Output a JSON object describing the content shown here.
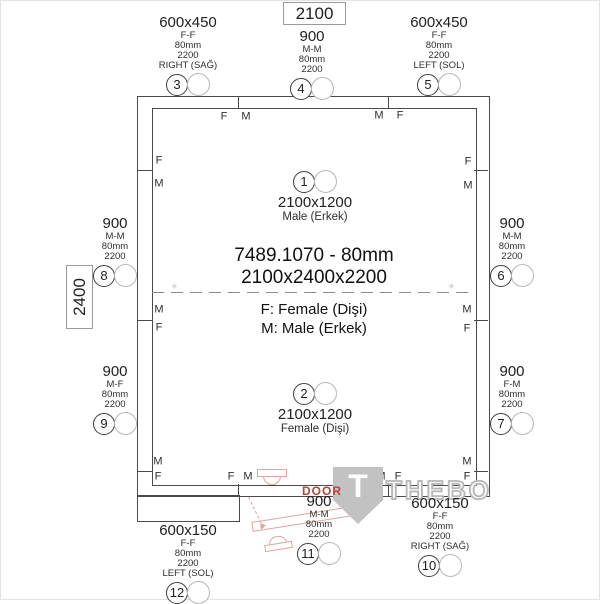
{
  "header": {
    "title": "7489.1070 - 80mm",
    "dims": "2100x2400x2200",
    "legend_f": "F: Female (Dişi)",
    "legend_m": "M: Male (Erkek)"
  },
  "dimensions": {
    "width": "2100",
    "depth": "2400"
  },
  "interior": {
    "c1": {
      "num": "1",
      "size": "2100x1200",
      "type": "Male (Erkek)"
    },
    "c2": {
      "num": "2",
      "size": "2100x1200",
      "type": "Female (Dişi)"
    }
  },
  "callouts": {
    "p3": {
      "size": "600x450",
      "joint": "F-F",
      "thickness": "80mm",
      "height": "2200",
      "orient": "RIGHT (SAĞ)",
      "num": "3"
    },
    "p4": {
      "size": "900",
      "joint": "M-M",
      "thickness": "80mm",
      "height": "2200",
      "num": "4"
    },
    "p5": {
      "size": "600x450",
      "joint": "F-F",
      "thickness": "80mm",
      "height": "2200",
      "orient": "LEFT (SOL)",
      "num": "5"
    },
    "p6": {
      "size": "900",
      "joint": "M-M",
      "thickness": "80mm",
      "height": "2200",
      "num": "6"
    },
    "p7": {
      "size": "900",
      "joint": "F-M",
      "thickness": "80mm",
      "height": "2200",
      "num": "7"
    },
    "p8": {
      "size": "900",
      "joint": "M-M",
      "thickness": "80mm",
      "height": "2200",
      "num": "8"
    },
    "p9": {
      "size": "900",
      "joint": "M-F",
      "thickness": "80mm",
      "height": "2200",
      "num": "9"
    },
    "p10": {
      "size": "600x150",
      "joint": "F-F",
      "thickness": "80mm",
      "height": "2200",
      "orient": "RIGHT (SAĞ)",
      "num": "10"
    },
    "p11": {
      "size": "900",
      "joint": "M-M",
      "thickness": "80mm",
      "height": "2200",
      "num": "11"
    },
    "p12": {
      "size": "600x150",
      "joint": "F-F",
      "thickness": "80mm",
      "height": "2200",
      "orient": "LEFT (SOL)",
      "num": "12"
    }
  },
  "fm": [
    "F",
    "M",
    "M",
    "F",
    "F",
    "M",
    "F",
    "M",
    "M",
    "F",
    "M",
    "F",
    "M",
    "F",
    "M",
    "F",
    "F",
    "M",
    "M",
    "F"
  ],
  "door": {
    "label": "DOOR"
  },
  "watermark": {
    "initial": "T",
    "name": "THEBO",
    "reg": "®"
  },
  "colors": {
    "line": "#4a4a4a",
    "door_accent": "#b5433c",
    "door_light": "#dca59e",
    "watermark_gray": "#c2c2c2"
  }
}
